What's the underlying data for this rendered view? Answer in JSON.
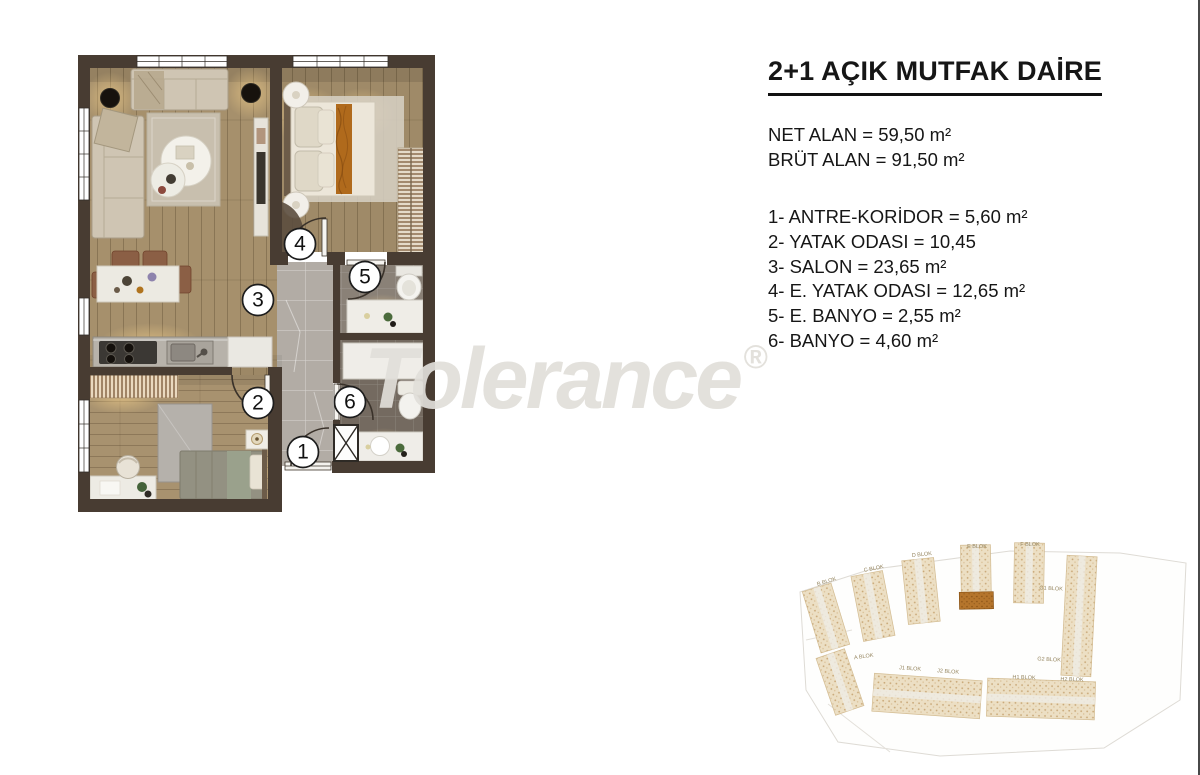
{
  "info_panel": {
    "title": "2+1 AÇIK MUTFAK DAİRE",
    "net_area": "NET ALAN = 59,50 m²",
    "gross_area": "BRÜT ALAN = 91,50 m²",
    "room_list": [
      "1- ANTRE-KORİDOR = 5,60 m²",
      "2- YATAK ODASI = 10,45",
      "3- SALON = 23,65 m²",
      "4- E. YATAK ODASI = 12,65 m²",
      "5- E. BANYO = 2,55 m²",
      "6- BANYO = 4,60 m²"
    ]
  },
  "watermark": {
    "text": "Tolerance",
    "registered_mark": "®"
  },
  "floor_plan": {
    "room_numbers": [
      "1",
      "2",
      "3",
      "4",
      "5",
      "6"
    ]
  },
  "site_plan": {
    "block_labels": [
      "B BLOK",
      "C BLOK",
      "D BLOK",
      "E BLOK",
      "F BLOK",
      "G1 BLOK",
      "G2 BLOK",
      "A BLOK",
      "J1 BLOK",
      "J2 BLOK",
      "H1 BLOK",
      "H2 BLOK"
    ],
    "highlight_color": "#a96b24"
  },
  "colors": {
    "wall": "#483c32",
    "wood_floor": "#a6906c",
    "corridor_tile": "#b2aca5",
    "accent_throw": "#b06a1c"
  }
}
